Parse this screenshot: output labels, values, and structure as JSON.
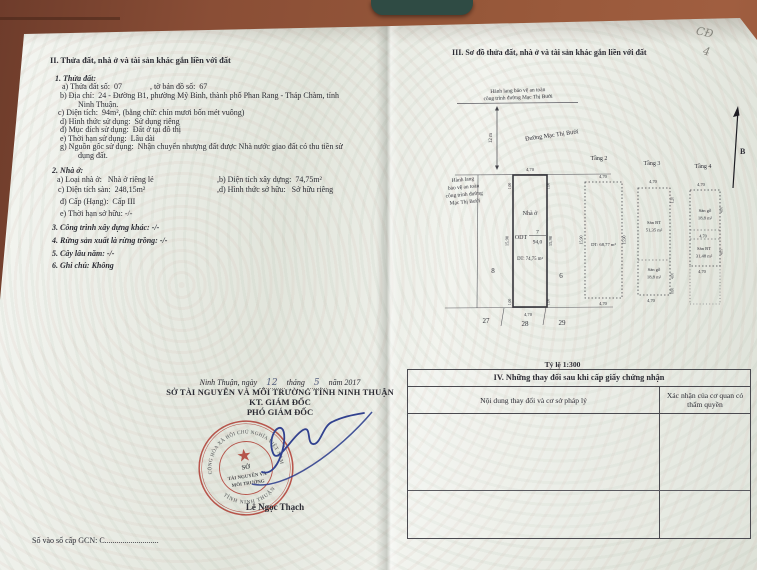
{
  "left_page": {
    "section_title": "II. Thửa đất, nhà ở và tài sản khác gắn liền với đất",
    "land": {
      "heading": "1. Thửa đất:",
      "line_a": "a) Thửa đất số:  07              , tờ bản đồ số:  67",
      "line_b1": "b) Địa chỉ:  24 - Đường B1, phường Mỹ Bình, thành phố Phan Rang - Tháp Chàm, tỉnh",
      "line_b2": "Ninh Thuận.",
      "line_c": "c) Diện tích:  94m², (bằng chữ: chín mươi bốn mét vuông)",
      "line_d": "d) Hình thức sử dụng:  Sử dụng riêng",
      "line_dd": "đ) Mục đích sử dụng:  Đất ở tại đô thị",
      "line_e": "e) Thời hạn sử dụng:  Lâu dài",
      "line_g1": "g) Nguồn gốc sử dụng:  Nhận chuyển nhượng đất được Nhà nước giao đất có thu tiền sử",
      "line_g2": "dụng đất."
    },
    "house": {
      "heading": "2. Nhà ở:",
      "line_a": "a) Loại nhà ở:   Nhà ở riêng lẻ",
      "line_b": ",b) Diện tích xây dựng:  74,75m²",
      "line_c": "c) Diện tích sàn:  248,15m²",
      "line_d": ",d) Hình thức sở hữu:   Sở hữu riêng",
      "line_dd": "đ) Cấp (Hạng):  Cấp III",
      "line_e": "e) Thời hạn sở hữu: -/-"
    },
    "items": {
      "item3": "3. Công trình xây dựng khác: -/-",
      "item4": "4. Rừng sản xuất là rừng trồng: -/-",
      "item5": "5. Cây lâu năm: -/-",
      "item6": "6. Ghi chú: Không"
    },
    "signing": {
      "place_prefix": "Ninh Thuận, ngày",
      "day": "12",
      "month_word": "tháng",
      "month": "5",
      "year_word": "năm 2017",
      "agency": "SỞ TÀI NGUYÊN VÀ MÔI TRƯỜNG TỈNH NINH THUẬN",
      "kt": "KT. GIÁM ĐỐC",
      "position": "PHÓ GIÁM ĐỐC",
      "signer": "Lê Ngọc Thạch"
    },
    "stamp": {
      "arc_top": "CỘNG HÒA XÃ HỘI CHỦ NGHĨA VIỆT NAM",
      "arc_bottom": "TỈNH NINH THUẬN",
      "center1": "SỞ",
      "center2": "TÀI NGUYÊN VÀ",
      "center3": "MÔI TRƯỜNG",
      "color": "#c43a31"
    },
    "footer": "Số vào sổ cấp GCN: C..........................."
  },
  "right_page": {
    "section_title": "III. Sơ đồ thửa đất, nhà ở và tài sản khác gắn liền với đất",
    "diagram": {
      "corridor_note_l1": "Hành lang bảo vệ an toàn",
      "corridor_note_l2": "công trình đường Mạc Thị Bưởi",
      "road_width": "12 m",
      "street_name": "Đường Mạc Thị Bưởi",
      "side_note_l1": "Hành lang",
      "side_note_l2": "bảo vệ an toàn",
      "side_note_l3": "công trình đường",
      "side_note_l4": "Mạc Thị Bưởi",
      "parcel": {
        "label": "Nhà ở",
        "use_code": "ODT",
        "number": "7",
        "area": "94,0",
        "built_area": "DT: 74,75 m²",
        "width_top": "4,70",
        "width_bottom": "4,70",
        "depth_left": "15,90",
        "depth_right": "15,90",
        "corner": "1,00"
      },
      "neighbors": {
        "left": "8",
        "right": "6",
        "b1": "27",
        "b2": "28",
        "b3": "29"
      },
      "north_label": "B",
      "floor2": {
        "name": "Tầng 2",
        "top": "4,70",
        "left": "15,90",
        "right": "15,90",
        "area": "DT: 68,77 m²",
        "bottom": "4,70"
      },
      "floor3": {
        "name": "Tầng 3",
        "top": "4,70",
        "part1": "Sàn BT",
        "part1_area": "51,35 m²",
        "part2": "Sàn gỗ",
        "part2_area": "18,8 m²",
        "bottom": "4,70",
        "dim1": "1,20",
        "dim2": "4,00",
        "dim3": "0,60"
      },
      "floor4": {
        "name": "Tầng 4",
        "top": "4,70",
        "part1": "Sàn gỗ",
        "part1_area": "18,8 m²",
        "mid": "4,70",
        "part2": "Sàn BT",
        "part2_area": "31,48 m²",
        "bottom": "4,70",
        "dim1": "4,00",
        "dim2": "4,05"
      },
      "scale": "Tỷ lệ 1:300"
    },
    "changes_table": {
      "title": "IV. Những thay đổi sau khi cấp giấy chứng nhận",
      "col1": "Nội dung thay đổi và cơ sở pháp lý",
      "col2": "Xác nhận của cơ quan có thẩm quyền"
    }
  },
  "photo": {
    "pencil_note": [
      "CĐ",
      "4"
    ]
  }
}
